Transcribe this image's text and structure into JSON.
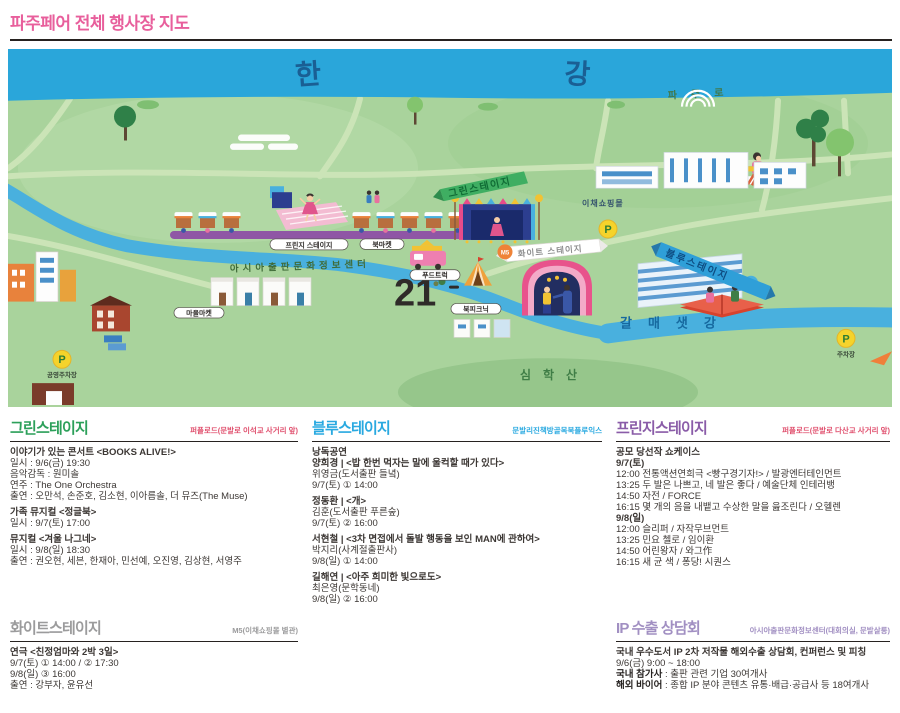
{
  "page": {
    "title": "파주페어 전체 행사장 지도"
  },
  "map": {
    "han": "한",
    "gang": "강",
    "road": "파주로",
    "stream": "갈매샛강",
    "mountain": "심학산",
    "green_stage": "그린스테이지",
    "fringe_stage": "프린지 스테이지",
    "white_stage": "화이트 스테이지",
    "white_stage_badge": "M5",
    "blue_stage": "블루스테이지",
    "book_market": "북마켓",
    "food_truck": "푸드트럭",
    "book_picnic": "북피크닉",
    "village_market": "마을마켓",
    "shopping_mall": "이채쇼핑몰",
    "info_center": "아시아출판문화정보센터",
    "building_21": "21",
    "parking": "P",
    "parking_left": "공영주차장",
    "parking_right": "주차장"
  },
  "sections": {
    "green": {
      "title": "그린스테이지",
      "location": "퍼플로드(문발로 이석교 사거리 앞)",
      "events": [
        {
          "title": "이야기가 있는 콘서트 <BOOKS ALIVE!>",
          "lines": [
            "일시 : 9/6(금) 19:30",
            "음악감독 : 원미솔",
            "연주 : The One Orchestra",
            "출연 : 오만석, 손준호, 김소현, 이아름솔, 더 뮤즈(The Muse)"
          ]
        },
        {
          "title": "가족 뮤지컬 <정글북>",
          "lines": [
            "일시 : 9/7(토) 17:00"
          ]
        },
        {
          "title": "뮤지컬 <겨울 나그네>",
          "lines": [
            "일시 : 9/8(일) 18:30",
            "출연 : 권오현, 세븐, 한재아, 민선예, 오진영, 김상현, 서영주"
          ]
        }
      ]
    },
    "blue": {
      "title": "블루스테이지",
      "location": "문발리진책방골목북플루익스",
      "pretitle": "낭독공연",
      "events": [
        {
          "title": "양희경 | <밥 한번 먹자는 말에 울컥할 때가 있다>",
          "lines": [
            "위영금(도서출판 들녘)",
            "9/7(토) ① 14:00"
          ]
        },
        {
          "title": "정동환 | <개>",
          "lines": [
            "김훈(도서출판 푸른숲)",
            "9/7(토) ② 16:00"
          ]
        },
        {
          "title": "서현철 | <3차 면접에서 돌발 행동을 보인 MAN에 관하여>",
          "lines": [
            "박지리(사계절출판사)",
            "9/8(일) ① 14:00"
          ]
        },
        {
          "title": "길해연 | <아주 희미한 빛으로도>",
          "lines": [
            "최은영(문학동네)",
            "9/8(일) ② 16:00"
          ]
        }
      ]
    },
    "fringe": {
      "title": "프린지스테이지",
      "location": "퍼플로드(문발로 다산교 사거리 앞)",
      "showcase_title": "공모 당선작 쇼케이스",
      "days": [
        {
          "day": "9/7(토)",
          "items": [
            "12:00 전통액션연희극 <빵구경기자!> / 발광엔터테인먼트",
            "13:25 두 발은 나쁘고, 네 발은 좋다 / 예술단체 인테러뱅",
            "14:50 자전 / FORCE",
            "16:15 몇 개의 음을 내뱉고 수상한 말을 읊조린다 / 오헬렌"
          ]
        },
        {
          "day": "9/8(일)",
          "items": [
            "12:00 슬리퍼 / 자작무브먼트",
            "13:25 민요 첼로 / 임이환",
            "14:50 어린왕자 / 와그作",
            "16:15 새 균 색 / 퐁당! 시퀀스"
          ]
        }
      ]
    },
    "white": {
      "title": "화이트스테이지",
      "location": "M5(이채쇼핑몰 별관)",
      "events": [
        {
          "title": "연극 <친정엄마와 2박 3일>",
          "lines": [
            "9/7(토) ① 14:00 / ② 17:30",
            "9/8(일) ③ 16:00",
            "출연 : 강부자, 윤유선"
          ]
        }
      ]
    },
    "ip": {
      "title": "IP 수출 상담회",
      "location": "아시아출판문화정보센터(대회의실, 문발살롱)",
      "lines": [
        "국내 우수도서 IP 2차 저작물 해외수출 상담회, 컨퍼런스 및 피칭",
        "9/6(금) 9:00 ~ 18:00"
      ],
      "details": [
        {
          "label": "국내 참가사",
          "value": " : 출판 관련 기업 30여개사"
        },
        {
          "label": "해외 바이어",
          "value": " : 종합 IP 분야 콘텐츠 유통·배급·공급사 등 18여개사"
        }
      ]
    }
  }
}
